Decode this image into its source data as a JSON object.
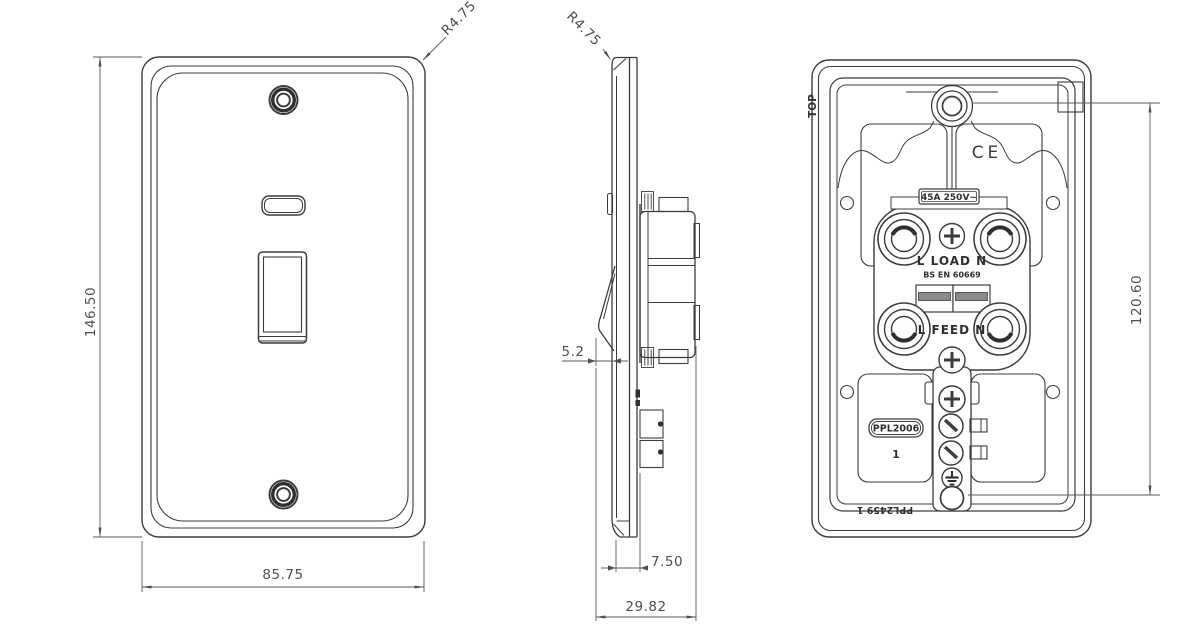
{
  "drawing": {
    "colors": {
      "line": "#3c3c3c",
      "dim": "#5a5a5a",
      "background": "#ffffff",
      "dark_fill": "#2f2f2f"
    },
    "front_view": {
      "radius_label": "R4.75",
      "height_dim": "146.50",
      "width_dim": "85.75"
    },
    "side_view": {
      "radius_label": "R4.75",
      "rocker_projection_dim": "5.2",
      "plate_depth_dim": "7.50",
      "overall_depth_dim": "29.82"
    },
    "rear_view": {
      "orientation_label": "TOP",
      "ce_mark": "CE",
      "rating_label": "45A 250V~",
      "load_label": "L LOAD N",
      "standard_label": "BS EN 60669",
      "feed_label": "L FEED N",
      "part_label": "PPL2006",
      "gang_label": "1",
      "mould_label": "PPL2459 1",
      "fixing_centres_dim": "120.60"
    }
  }
}
